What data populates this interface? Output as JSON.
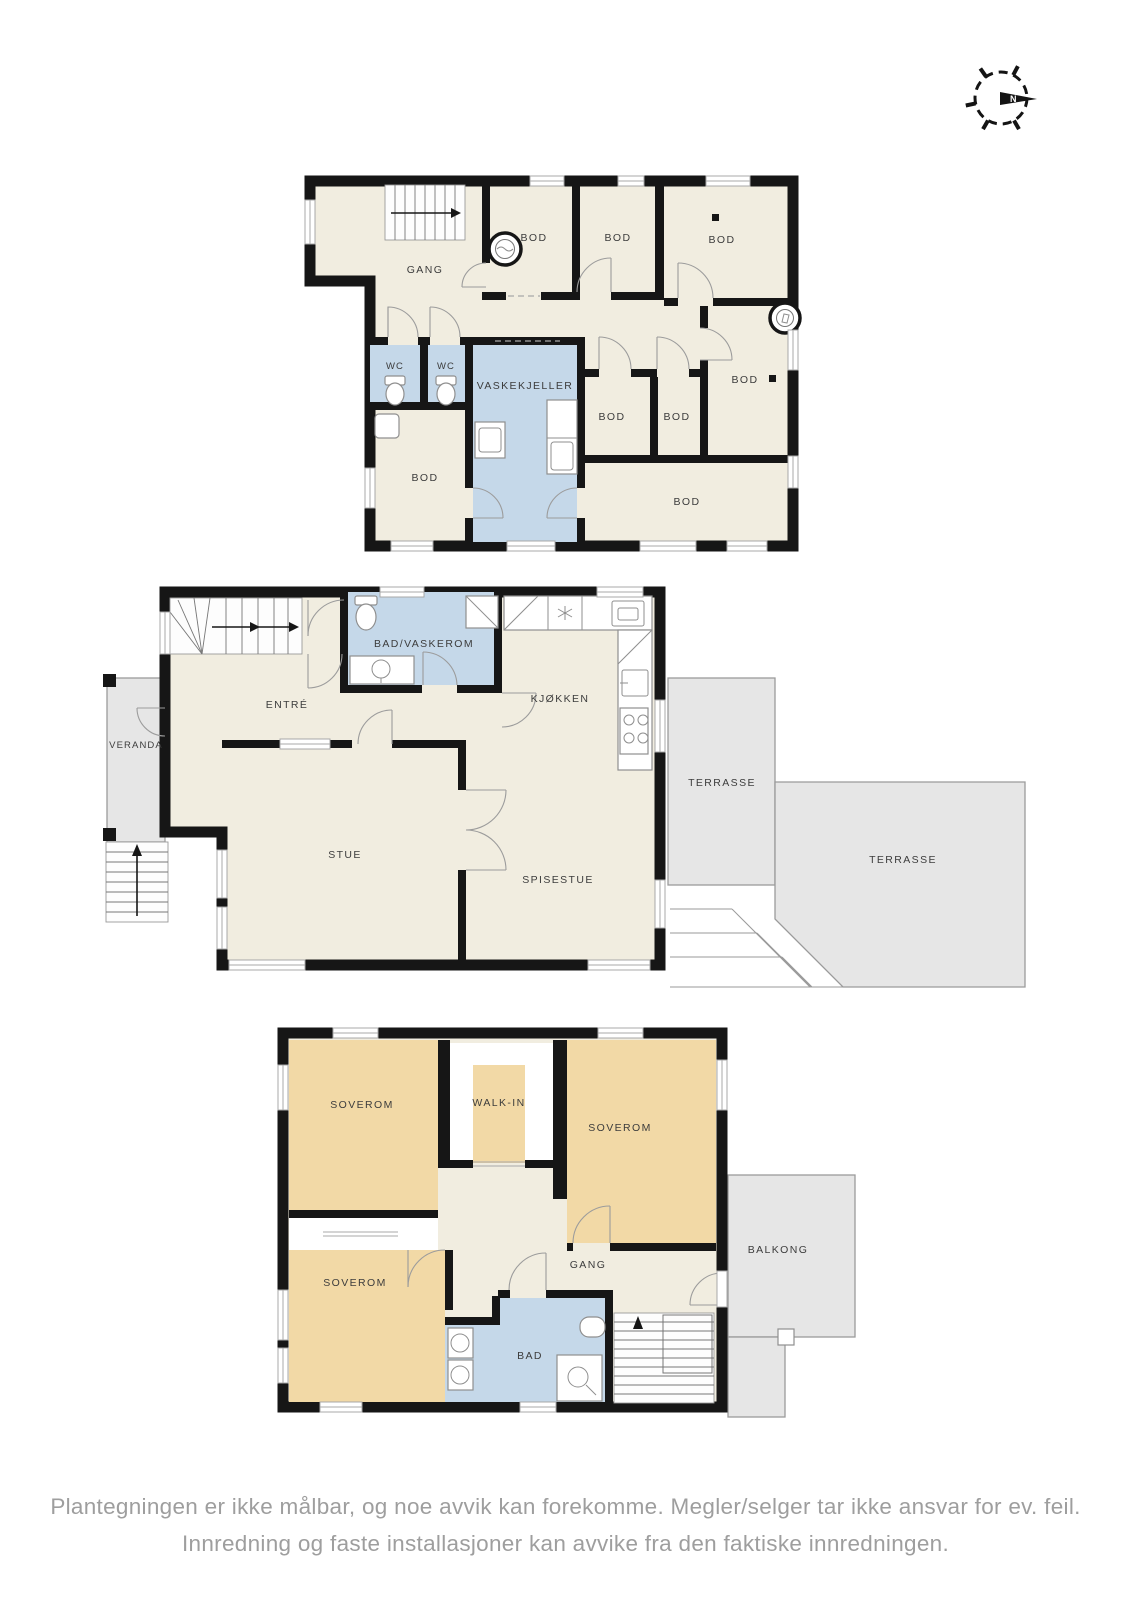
{
  "document": {
    "type": "floor-plan-sheet"
  },
  "colors": {
    "room_cream": "#f1ede0",
    "wet_room_blue": "#c5d8e9",
    "bedroom_tan": "#f2d9a6",
    "outdoor_grey": "#e6e6e6",
    "wall_black": "#161616",
    "label_grey": "#3c3c3c",
    "disclaimer_grey": "#9e9e9e"
  },
  "compass": {
    "north_label": "N"
  },
  "floor1": {
    "rooms": {
      "gang": "GANG",
      "bod_top_1": "BOD",
      "bod_top_2": "BOD",
      "bod_top_3": "BOD",
      "bod_right": "BOD",
      "wc_1": "WC",
      "wc_2": "WC",
      "vaskekjeller": "VASKEKJELLER",
      "bod_left": "BOD",
      "bod_mid_1": "BOD",
      "bod_mid_2": "BOD",
      "bod_bottom": "BOD"
    }
  },
  "floor2": {
    "rooms": {
      "entre": "ENTRÉ",
      "bad_vaskerom": "BAD/VASKEROM",
      "kjokken": "KJØKKEN",
      "veranda": "VERANDA",
      "stue": "STUE",
      "spisestue": "SPISESTUE",
      "terrasse_1": "TERRASSE",
      "terrasse_2": "TERRASSE"
    }
  },
  "floor3": {
    "rooms": {
      "soverom_1": "SOVEROM",
      "walk_in": "WALK-IN",
      "soverom_2": "SOVEROM",
      "soverom_3": "SOVEROM",
      "gang": "GANG",
      "bad": "BAD",
      "balkong": "BALKONG"
    }
  },
  "disclaimer": {
    "line_1": "Plantegningen er ikke målbar, og noe avvik kan forekomme. Megler/selger tar ikke ansvar for ev. feil.",
    "line_2": "Innredning og faste installasjoner kan avvike fra den faktiske innredningen."
  }
}
